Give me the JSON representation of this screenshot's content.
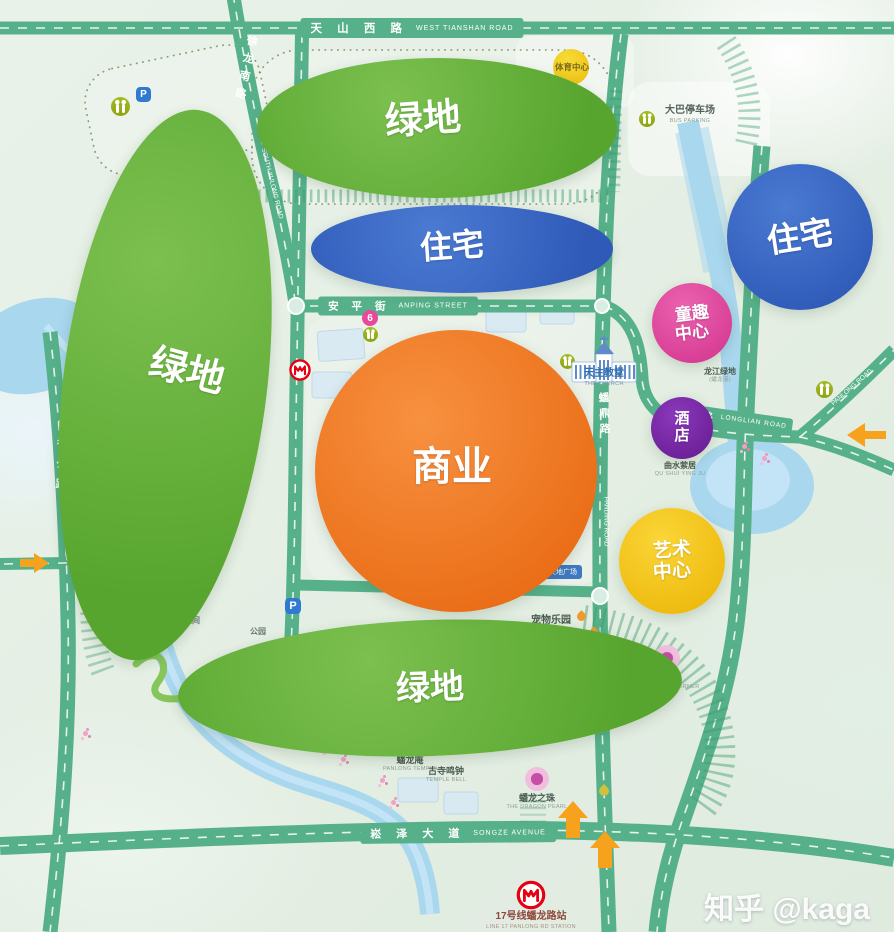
{
  "watermark": "知乎 @kaga",
  "colors": {
    "road": "#56b18a",
    "river": "#a9d7ee",
    "green_zone": "#68b23d",
    "blue_zone": "#3a6cc6",
    "orange_zone": "#ef7a26",
    "pink_zone": "#e4459c",
    "purple_zone": "#7a28a8",
    "yellow_zone": "#f6c31c",
    "arrow": "#f7a21c",
    "metro_red": "#e60012"
  },
  "roads": {
    "tianshan": {
      "zh": "天 山 西 路",
      "en": "WEST TIANSHAN ROAD"
    },
    "anping": {
      "zh": "安 平 街",
      "en": "ANPING STREET"
    },
    "songze": {
      "zh": "崧 泽 大 道",
      "en": "SONGZE AVENUE"
    },
    "huxu": {
      "zh": "华徐公路",
      "en": "HUXU ROAD"
    },
    "xulong": {
      "zh": "徐龙南路",
      "en": "SOUTH XULONG ROAD"
    },
    "panding": {
      "zh": "蟠鼎路",
      "en": "PANDING ROAD"
    },
    "longlian": {
      "zh": "龙联路",
      "en": "LONGLIAN ROAD"
    },
    "panlong": {
      "en": "PANLONG ROAD"
    }
  },
  "zones": {
    "green_top": "绿地",
    "green_left": "绿地",
    "green_bottom": "绿地",
    "residential_mid": "住宅",
    "residential_right": "住宅",
    "commercial": "商业",
    "kids": [
      "童趣",
      "中心"
    ],
    "hotel": [
      "酒",
      "店"
    ],
    "art": [
      "艺术",
      "中心"
    ]
  },
  "pois": {
    "sports": {
      "zh": "体育中心"
    },
    "bus": {
      "zh": "大巴停车场",
      "en": "BUS PARKING"
    },
    "church": {
      "zh": "天主教堂",
      "en": "THE CHURCH"
    },
    "longjiang": {
      "zh": "龙江绿地",
      "en": "(蟠龙港)"
    },
    "qushui": {
      "zh": "曲水萦居",
      "en": "QU SHUI YING JU"
    },
    "pets": {
      "zh": "宠物乐园",
      "en": "PETS PARK"
    },
    "gaodi": {
      "zh": "高地广场",
      "en": "HIGHLAND PLAZA"
    },
    "xiehou": {
      "zh": "邂逅角",
      "en": "ENCOUNTER CORNER"
    },
    "gusi": {
      "zh": "古寺鸣钟",
      "en": "TEMPLE BELL"
    },
    "panlongan": {
      "zh": "蟠龙庵",
      "en": "PANLONG TEMPLE"
    },
    "pearl": {
      "zh": "蟠龙之珠",
      "en": "THE DRAGON PEARL"
    },
    "tiandi": {
      "zh": "天地广场"
    },
    "wild": {
      "zh": "野空间"
    },
    "park": {
      "zh": "公园"
    }
  },
  "station": {
    "zh": "17号线蟠龙路站",
    "en": "LINE 17 PANLONG RD STATION"
  },
  "markers": {
    "six": "6",
    "parking": "P"
  }
}
